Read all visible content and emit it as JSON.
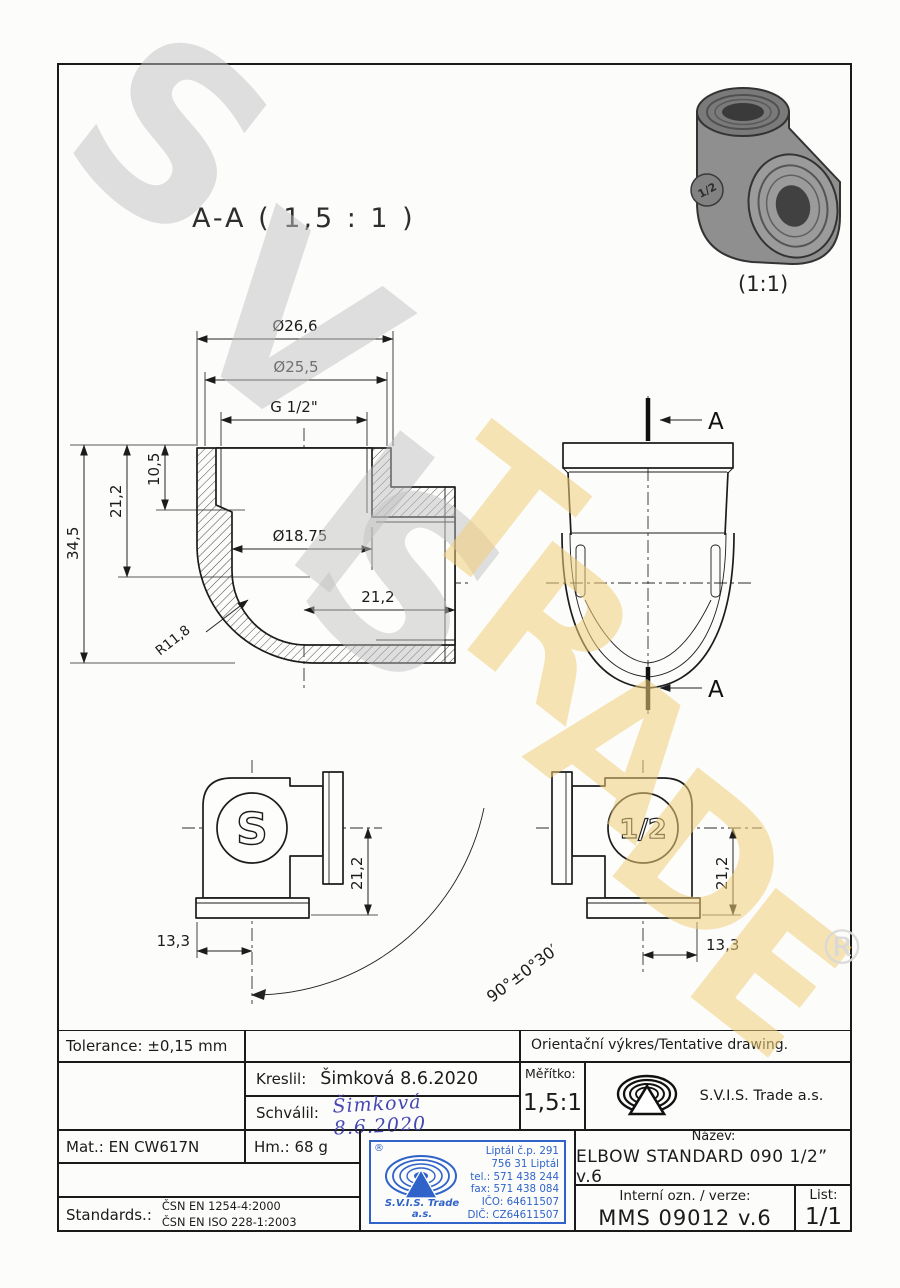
{
  "colors": {
    "line": "#1c1c1c",
    "watermark_gray": "#c2c2c2",
    "watermark_yellow": "#f2cf7a",
    "stamp_blue": "#2f63c9",
    "signature_blue": "#4547b2"
  },
  "watermark": {
    "letters": [
      {
        "ch": "S"
      },
      {
        "ch": "V"
      },
      {
        "ch": "I"
      },
      {
        "ch": "S"
      },
      {
        "ch": "T"
      },
      {
        "ch": "R"
      },
      {
        "ch": "A"
      },
      {
        "ch": "D"
      },
      {
        "ch": "E"
      }
    ],
    "registered": "®"
  },
  "photo": {
    "caption": "(1:1)",
    "stamp": "1/2"
  },
  "section_view": {
    "title": "A-A ( 1,5 : 1 )",
    "dims": {
      "dia_outer": "Ø26,6",
      "dia_mid": "Ø25,5",
      "thread": "G 1/2\"",
      "height_total": "34,5",
      "height_mid": "21,2",
      "height_top": "10,5",
      "bore_dia": "Ø18.75",
      "depth": "21,2",
      "radius": "R11,8"
    }
  },
  "side_view": {
    "label_top": "A",
    "label_bottom": "A"
  },
  "front_view": {
    "stamp": "S",
    "height": "21,2",
    "offset": "13,3",
    "angle": "90°±0°30′"
  },
  "back_view": {
    "stamp": "1/2",
    "height": "21,2",
    "offset": "13,3"
  },
  "title_block": {
    "tolerance": "Tolerance: ±0,15 mm",
    "tentative": "Orientační výkres/Tentative drawing.",
    "kreslil_label": "Kreslil:",
    "kreslil_value": "Šimková 8.6.2020",
    "schvalil_label": "Schválil:",
    "schvalil_signature": "Šimková 8.6.2020",
    "meritko_label": "Měřítko:",
    "meritko_value": "1,5:1",
    "company": "S.V.I.S. Trade a.s.",
    "mat": "Mat.: EN CW617N",
    "hm": "Hm.: 68 g",
    "standards_label": "Standards.:",
    "standard1": "ČSN EN 1254-4:2000",
    "standard2": "ČSN EN ISO 228-1:2003",
    "nazev_label": "Název:",
    "nazev_value": "ELBOW STANDARD 090 1/2” v.6",
    "interni_label": "Interní ozn. / verze:",
    "interni_value": "MMS 09012 v.6",
    "list_label": "List:",
    "list_value": "1/1",
    "stamp": {
      "registered": "®",
      "company_line1": "S.V.I.S. Trade",
      "company_line2": "a.s.",
      "address1": "Liptál č.p. 291",
      "address2": "756 31 Liptál",
      "address3": "tel.: 571 438 244",
      "address4": "fax: 571 438 084",
      "address5": "IČO: 64611507",
      "address6": "DIČ: CZ64611507"
    }
  }
}
